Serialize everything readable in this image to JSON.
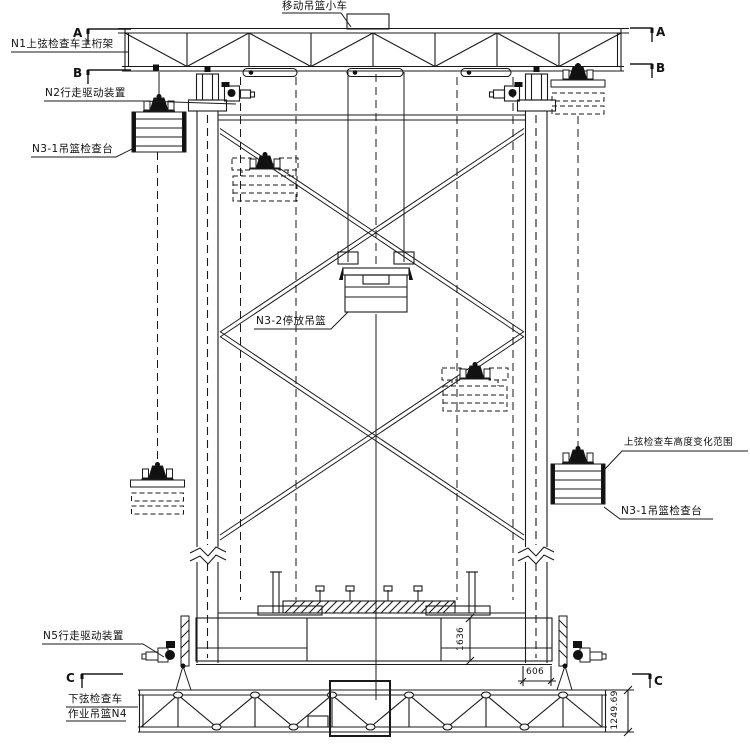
{
  "drawing": {
    "labels": {
      "moving_trolley": "移动吊篮小车",
      "n1_main_truss": "N1上弦检查车主桁架",
      "n2_drive": "N2行走驱动装置",
      "n3_1_left": "N3-1吊篮检查台",
      "n3_2_parked_basket": "N3-2停放吊篮",
      "height_range": "上弦检查车高度变化范围",
      "n3_1_right": "N3-1吊篮检查台",
      "n5_drive": "N5行走驱动装置",
      "lower_vehicle_line1": "下弦检查车",
      "lower_vehicle_line2": "作业吊篮N4"
    },
    "sections": {
      "a": "A",
      "b": "B",
      "c": "C"
    },
    "dims": {
      "d606": "606",
      "d1636": "1636",
      "d1249": "1249.69"
    },
    "colors": {
      "background": "#ffffff",
      "line": "#1a1a1a"
    }
  }
}
